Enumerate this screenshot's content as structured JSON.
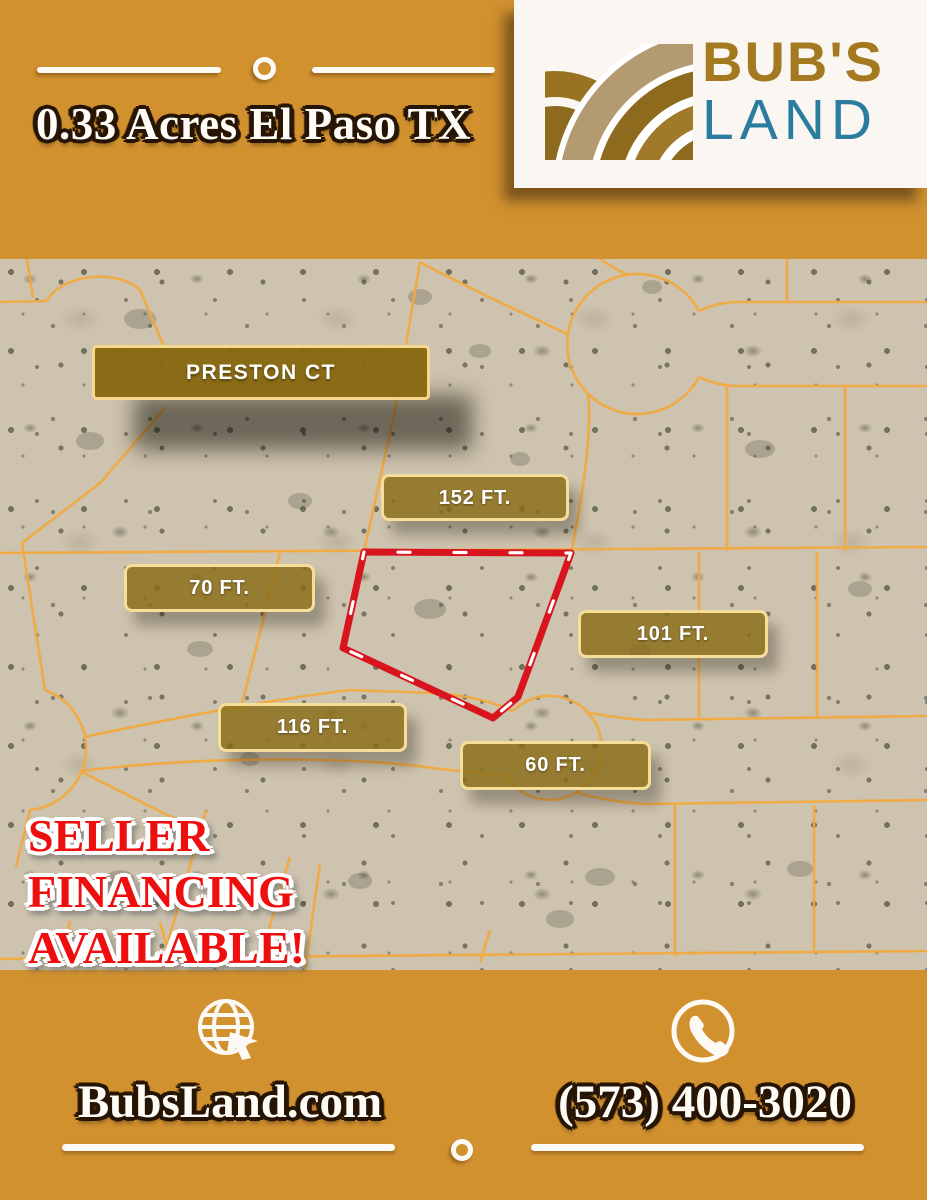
{
  "title": "0.33 Acres El Paso TX",
  "logo": {
    "line1": "BUB'S",
    "line2": "LAND"
  },
  "map": {
    "street_sign": "PRESTON CT",
    "dimensions": [
      {
        "text": "152 FT."
      },
      {
        "text": "70 FT."
      },
      {
        "text": "101 FT."
      },
      {
        "text": "116 FT."
      },
      {
        "text": "60 FT."
      }
    ]
  },
  "promo": {
    "lines": [
      "SELLER",
      "FINANCING",
      "AVAILABLE!"
    ]
  },
  "footer": {
    "website": "BubsLand.com",
    "phone": "(573) 400-3020"
  },
  "colors": {
    "background_gold": "#d1912f",
    "card_white": "#faf6f2",
    "parcel_line_orange": "#f4a93d",
    "boundary_red": "#d8141e",
    "sign_gold": "#86670e",
    "sign_border": "#f8d88e",
    "logo_gold": "#a5791f",
    "logo_teal": "#2b7c9e",
    "promo_red": "#ef0e0e",
    "map_sand": "#cdc3ae"
  }
}
